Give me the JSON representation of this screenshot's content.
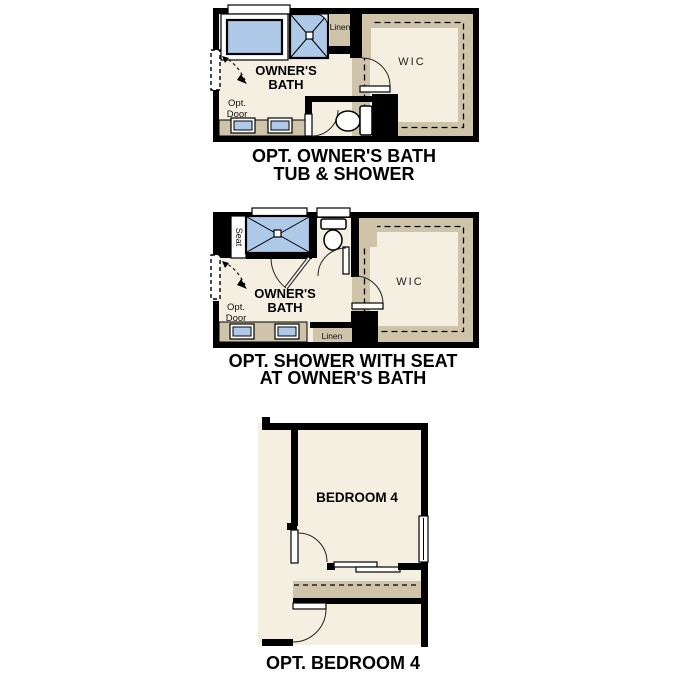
{
  "colors": {
    "background": "#ffffff",
    "wall": "#000000",
    "floor": "#f5efe2",
    "shelf_tan": "#cfc4aa",
    "fixture_blue": "#aecae8"
  },
  "plans": [
    {
      "id": "owners-bath-tub-shower",
      "caption_line1": "OPT. OWNER'S BATH",
      "caption_line2": "TUB & SHOWER",
      "room_label_line1": "OWNER'S",
      "room_label_line2": "BATH",
      "wic_label": "WIC",
      "linen_label": "Linen",
      "opt_door_line1": "Opt.",
      "opt_door_line2": "Door"
    },
    {
      "id": "owners-bath-shower-seat",
      "caption_line1": "OPT. SHOWER WITH SEAT",
      "caption_line2": "AT OWNER'S BATH",
      "room_label_line1": "OWNER'S",
      "room_label_line2": "BATH",
      "wic_label": "WIC",
      "linen_label": "Linen",
      "seat_label": "Seat",
      "opt_door_line1": "Opt.",
      "opt_door_line2": "Door"
    },
    {
      "id": "bedroom-4",
      "caption": "OPT. BEDROOM 4",
      "room_label": "BEDROOM 4"
    }
  ]
}
